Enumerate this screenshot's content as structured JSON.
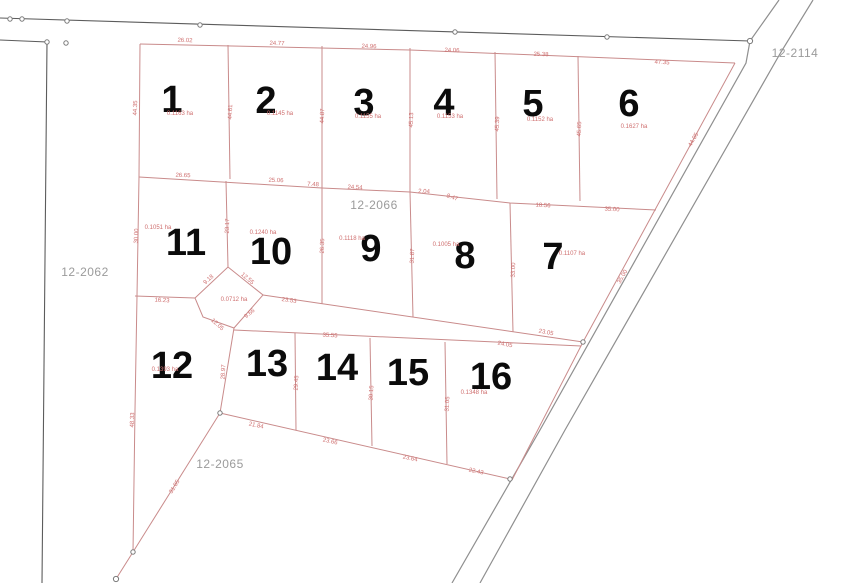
{
  "colors": {
    "lot_line": "#c98b8b",
    "dimension_text": "#cf6f6f",
    "neighbor_line": "#8f8f8f",
    "lot_number_text": "#0b0b0b",
    "parcel_id_text": "#9b9b9b",
    "background": "#ffffff"
  },
  "parcels": [
    {
      "label": "12-2114",
      "x": 795,
      "y": 53
    },
    {
      "label": "12-2062",
      "x": 85,
      "y": 272
    },
    {
      "label": "12-2066",
      "x": 374,
      "y": 205
    },
    {
      "label": "12-2065",
      "x": 220,
      "y": 464
    }
  ],
  "lots": [
    {
      "number": "1",
      "x": 172,
      "y": 100,
      "area": "0.1163 ha",
      "ax": 180,
      "ay": 114
    },
    {
      "number": "2",
      "x": 266,
      "y": 101,
      "area": "0.1145 ha",
      "ax": 280,
      "ay": 114
    },
    {
      "number": "3",
      "x": 364,
      "y": 103,
      "area": "0.1155 ha",
      "ax": 368,
      "ay": 117
    },
    {
      "number": "4",
      "x": 444,
      "y": 103,
      "area": "0.1153 ha",
      "ax": 450,
      "ay": 117
    },
    {
      "number": "5",
      "x": 533,
      "y": 104,
      "area": "0.1152 ha",
      "ax": 540,
      "ay": 120
    },
    {
      "number": "6",
      "x": 629,
      "y": 104,
      "area": "0.1627 ha",
      "ax": 634,
      "ay": 127
    },
    {
      "number": "7",
      "x": 553,
      "y": 257,
      "area": "0.1107 ha",
      "ax": 572,
      "ay": 254
    },
    {
      "number": "8",
      "x": 465,
      "y": 256,
      "area": "0.1005 ha",
      "ax": 446,
      "ay": 245
    },
    {
      "number": "9",
      "x": 371,
      "y": 249,
      "area": "0.1118 ha",
      "ax": 352,
      "ay": 239
    },
    {
      "number": "10",
      "x": 271,
      "y": 252,
      "area": "0.1240 ha",
      "ax": 263,
      "ay": 233
    },
    {
      "number": "11",
      "x": 186,
      "y": 243,
      "area": "0.1051 ha",
      "ax": 158,
      "ay": 228
    },
    {
      "number": "12",
      "x": 172,
      "y": 366,
      "area": "0.1393 ha",
      "ax": 165,
      "ay": 370
    },
    {
      "number": "13",
      "x": 267,
      "y": 364
    },
    {
      "number": "14",
      "x": 337,
      "y": 368
    },
    {
      "number": "15",
      "x": 408,
      "y": 373
    },
    {
      "number": "16",
      "x": 491,
      "y": 377,
      "area": "0.1348 ha",
      "ax": 474,
      "ay": 393
    },
    {
      "number": "",
      "x": 231,
      "y": 310,
      "area": "0.0712 ha",
      "ax": 234,
      "ay": 300
    }
  ],
  "dimensions": [
    {
      "t": "26.02",
      "x": 185,
      "y": 41,
      "r": 2
    },
    {
      "t": "24.77",
      "x": 277,
      "y": 44,
      "r": 2
    },
    {
      "t": "24.96",
      "x": 369,
      "y": 47,
      "r": 2
    },
    {
      "t": "24.06",
      "x": 452,
      "y": 51,
      "r": 2
    },
    {
      "t": "25.38",
      "x": 541,
      "y": 55,
      "r": 2
    },
    {
      "t": "47.35",
      "x": 662,
      "y": 63,
      "r": 3
    },
    {
      "t": "44.35",
      "x": 136,
      "y": 108,
      "r": -88
    },
    {
      "t": "44.61",
      "x": 231,
      "y": 112,
      "r": -88
    },
    {
      "t": "44.87",
      "x": 323,
      "y": 116,
      "r": -88
    },
    {
      "t": "45.13",
      "x": 412,
      "y": 120,
      "r": -88
    },
    {
      "t": "45.39",
      "x": 498,
      "y": 124,
      "r": -88
    },
    {
      "t": "45.65",
      "x": 580,
      "y": 129,
      "r": -88
    },
    {
      "t": "26.65",
      "x": 183,
      "y": 176,
      "r": 2
    },
    {
      "t": "25.06",
      "x": 276,
      "y": 181,
      "r": 2
    },
    {
      "t": "7.48",
      "x": 313,
      "y": 185,
      "r": 3
    },
    {
      "t": "24.54",
      "x": 355,
      "y": 188,
      "r": 3
    },
    {
      "t": "2.04",
      "x": 424,
      "y": 192,
      "r": 3
    },
    {
      "t": "8.47",
      "x": 452,
      "y": 198,
      "r": 20
    },
    {
      "t": "18.56",
      "x": 543,
      "y": 206,
      "r": 3
    },
    {
      "t": "35.00",
      "x": 612,
      "y": 210,
      "r": 3
    },
    {
      "t": "30.00",
      "x": 137,
      "y": 236,
      "r": -88
    },
    {
      "t": "23.17",
      "x": 228,
      "y": 226,
      "r": -88
    },
    {
      "t": "26.35",
      "x": 323,
      "y": 246,
      "r": -88
    },
    {
      "t": "31.87",
      "x": 413,
      "y": 256,
      "r": -88
    },
    {
      "t": "33.00",
      "x": 514,
      "y": 270,
      "r": -88
    },
    {
      "t": "44.05",
      "x": 694,
      "y": 140,
      "r": -61
    },
    {
      "t": "35.00",
      "x": 623,
      "y": 277,
      "r": -61
    },
    {
      "t": "23.53",
      "x": 289,
      "y": 301,
      "r": 8
    },
    {
      "t": "23.05",
      "x": 546,
      "y": 333,
      "r": 10
    },
    {
      "t": "24.05",
      "x": 505,
      "y": 345,
      "r": 10
    },
    {
      "t": "16.23",
      "x": 162,
      "y": 301,
      "r": 3
    },
    {
      "t": "35.55",
      "x": 330,
      "y": 336,
      "r": 3
    },
    {
      "t": "9.18",
      "x": 209,
      "y": 280,
      "r": -42
    },
    {
      "t": "12.55",
      "x": 247,
      "y": 279,
      "r": 40
    },
    {
      "t": "9.66",
      "x": 250,
      "y": 314,
      "r": -40
    },
    {
      "t": "12.05",
      "x": 217,
      "y": 325,
      "r": 42
    },
    {
      "t": "28.97",
      "x": 224,
      "y": 372,
      "r": -87
    },
    {
      "t": "29.45",
      "x": 297,
      "y": 383,
      "r": -87
    },
    {
      "t": "30.15",
      "x": 372,
      "y": 393,
      "r": -87
    },
    {
      "t": "31.05",
      "x": 448,
      "y": 404,
      "r": -87
    },
    {
      "t": "21.84",
      "x": 256,
      "y": 426,
      "r": 12
    },
    {
      "t": "23.66",
      "x": 330,
      "y": 442,
      "r": 12
    },
    {
      "t": "23.64",
      "x": 410,
      "y": 459,
      "r": 12
    },
    {
      "t": "22.43",
      "x": 476,
      "y": 472,
      "r": 12
    },
    {
      "t": "31.05",
      "x": 175,
      "y": 487,
      "r": -58
    },
    {
      "t": "48.33",
      "x": 133,
      "y": 420,
      "r": -88
    }
  ]
}
